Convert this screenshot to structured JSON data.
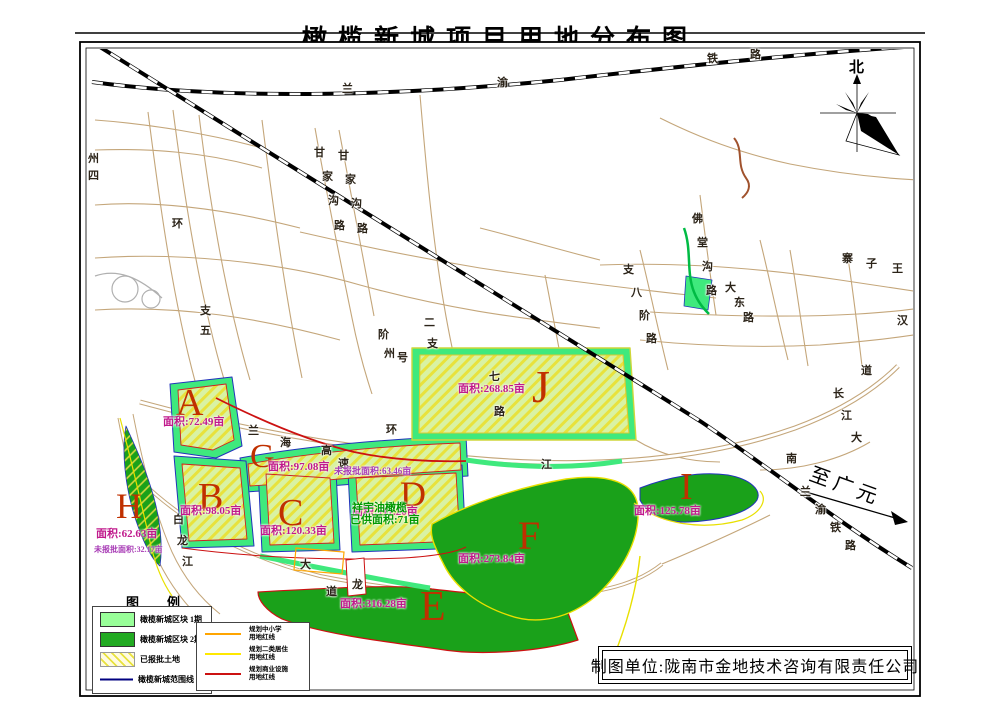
{
  "title": "橄榄新城项目用地分布图",
  "compass": {
    "north_label": "北"
  },
  "direction_note": {
    "text": "至广元"
  },
  "company_box": {
    "text": "制图单位:陇南市金地技术咨询有限责任公司"
  },
  "legend": {
    "title_char1": "图",
    "title_char2": "例",
    "swatches": [
      {
        "type": "sw-light",
        "label": "橄榄新城区块 1期"
      },
      {
        "type": "sw-dark",
        "label": "橄榄新城区块 2期"
      },
      {
        "type": "sw-hatch",
        "label": "已报批土地"
      },
      {
        "type": "sw-line",
        "label": "橄榄新城范围线"
      }
    ],
    "lines": [
      {
        "color": "#ffa500",
        "label1": "规划中小学",
        "label2": "用地红线"
      },
      {
        "color": "#ffe800",
        "label1": "规划二类居住",
        "label2": "用地红线"
      },
      {
        "color": "#cc1111",
        "label1": "规划商业设施",
        "label2": "用地红线"
      }
    ]
  },
  "zones": [
    {
      "letter": "A",
      "lx": 176,
      "ly": 384,
      "ls": 38,
      "area": "面积:72.49亩",
      "ax": 163,
      "ay": 417
    },
    {
      "letter": "G",
      "lx": 250,
      "ly": 440,
      "ls": 34,
      "area": "面积:97.08亩",
      "ax": 268,
      "ay": 462
    },
    {
      "letter": "B",
      "lx": 198,
      "ly": 478,
      "ls": 38,
      "area": "面积:98.05亩",
      "ax": 180,
      "ay": 506
    },
    {
      "letter": "C",
      "lx": 278,
      "ly": 494,
      "ls": 38,
      "area": "面积:120.33亩",
      "ax": 260,
      "ay": 526
    },
    {
      "letter": "D",
      "lx": 400,
      "ly": 476,
      "ls": 36,
      "area": "面积:111.20亩",
      "ax": 352,
      "ay": 507
    },
    {
      "letter": "J",
      "lx": 532,
      "ly": 364,
      "ls": 46,
      "area": "面积:268.85亩",
      "ax": 458,
      "ay": 384
    },
    {
      "letter": "E",
      "lx": 420,
      "ly": 586,
      "ls": 42,
      "area": "面积:316.28亩",
      "ax": 340,
      "ay": 599
    },
    {
      "letter": "F",
      "lx": 518,
      "ly": 516,
      "ls": 40,
      "area": "面积:273.84亩",
      "ax": 458,
      "ay": 554
    },
    {
      "letter": "H",
      "lx": 116,
      "ly": 488,
      "ls": 36,
      "area": "面积:62.63亩",
      "ax": 96,
      "ay": 529
    },
    {
      "letter": "I",
      "lx": 680,
      "ly": 468,
      "ls": 38,
      "area": "面积:125.78亩",
      "ax": 634,
      "ay": 506
    }
  ],
  "notes": [
    {
      "text": "未报批面积:63.46亩",
      "x": 334,
      "y": 467,
      "color": "#a73ab5",
      "size": 9
    },
    {
      "text": "祥宇油橄榄",
      "x": 352,
      "y": 502,
      "color": "#009900",
      "size": 11
    },
    {
      "text": "已供面积:71亩",
      "x": 350,
      "y": 514,
      "color": "#009900",
      "size": 11
    },
    {
      "text": "未报批面积:32.17亩",
      "x": 94,
      "y": 546,
      "color": "#a73ab5",
      "size": 8
    }
  ],
  "map_labels": [
    {
      "t": "兰",
      "x": 342,
      "y": 84
    },
    {
      "t": "渝",
      "x": 497,
      "y": 78
    },
    {
      "t": "铁",
      "x": 707,
      "y": 54
    },
    {
      "t": "路",
      "x": 750,
      "y": 50
    },
    {
      "t": "兰",
      "x": 800,
      "y": 487
    },
    {
      "t": "渝",
      "x": 815,
      "y": 505
    },
    {
      "t": "铁",
      "x": 830,
      "y": 523
    },
    {
      "t": "路",
      "x": 845,
      "y": 541
    },
    {
      "t": "兰",
      "x": 248,
      "y": 426
    },
    {
      "t": "海",
      "x": 280,
      "y": 438
    },
    {
      "t": "高",
      "x": 321,
      "y": 446
    },
    {
      "t": "速",
      "x": 338,
      "y": 459
    },
    {
      "t": "甘",
      "x": 314,
      "y": 148
    },
    {
      "t": "家",
      "x": 322,
      "y": 172
    },
    {
      "t": "沟",
      "x": 328,
      "y": 196
    },
    {
      "t": "路",
      "x": 334,
      "y": 221
    },
    {
      "t": "甘",
      "x": 338,
      "y": 151
    },
    {
      "t": "家",
      "x": 345,
      "y": 175
    },
    {
      "t": "沟",
      "x": 351,
      "y": 199
    },
    {
      "t": "路",
      "x": 357,
      "y": 224
    },
    {
      "t": "佛",
      "x": 692,
      "y": 214
    },
    {
      "t": "堂",
      "x": 697,
      "y": 238
    },
    {
      "t": "沟",
      "x": 702,
      "y": 262
    },
    {
      "t": "路",
      "x": 706,
      "y": 286
    },
    {
      "t": "大",
      "x": 725,
      "y": 283
    },
    {
      "t": "东",
      "x": 734,
      "y": 298
    },
    {
      "t": "路",
      "x": 743,
      "y": 313
    },
    {
      "t": "支",
      "x": 623,
      "y": 265
    },
    {
      "t": "八",
      "x": 631,
      "y": 288
    },
    {
      "t": "阶",
      "x": 639,
      "y": 311
    },
    {
      "t": "路",
      "x": 646,
      "y": 334
    },
    {
      "t": "七",
      "x": 489,
      "y": 372
    },
    {
      "t": "路",
      "x": 494,
      "y": 407
    },
    {
      "t": "道",
      "x": 861,
      "y": 366
    },
    {
      "t": "长",
      "x": 833,
      "y": 389
    },
    {
      "t": "江",
      "x": 841,
      "y": 411
    },
    {
      "t": "大",
      "x": 851,
      "y": 433
    },
    {
      "t": "南",
      "x": 786,
      "y": 454
    },
    {
      "t": "江",
      "x": 541,
      "y": 460
    },
    {
      "t": "白",
      "x": 173,
      "y": 515
    },
    {
      "t": "龙",
      "x": 177,
      "y": 536
    },
    {
      "t": "江",
      "x": 182,
      "y": 557
    },
    {
      "t": "龙",
      "x": 352,
      "y": 580
    },
    {
      "t": "大",
      "x": 300,
      "y": 560
    },
    {
      "t": "道",
      "x": 326,
      "y": 587
    },
    {
      "t": "支",
      "x": 200,
      "y": 306
    },
    {
      "t": "五",
      "x": 200,
      "y": 326
    },
    {
      "t": "州",
      "x": 88,
      "y": 154
    },
    {
      "t": "四",
      "x": 88,
      "y": 171
    },
    {
      "t": "二",
      "x": 424,
      "y": 318
    },
    {
      "t": "支",
      "x": 427,
      "y": 339
    },
    {
      "t": "号",
      "x": 397,
      "y": 353
    },
    {
      "t": "阶",
      "x": 378,
      "y": 330
    },
    {
      "t": "州",
      "x": 384,
      "y": 349
    },
    {
      "t": "环",
      "x": 386,
      "y": 425
    },
    {
      "t": "环",
      "x": 172,
      "y": 219
    },
    {
      "t": "寨",
      "x": 842,
      "y": 254
    },
    {
      "t": "子",
      "x": 866,
      "y": 259
    },
    {
      "t": "王",
      "x": 892,
      "y": 264
    },
    {
      "t": "汉",
      "x": 897,
      "y": 316
    }
  ],
  "colors": {
    "phase1_green": "#3fe97d",
    "phase2_green": "#1aa11a",
    "hatch_yellow": "#e8e23c",
    "boundary_blue": "#2233bb",
    "red_line": "#cc1111",
    "yellow_line": "#e8e000",
    "orange_line": "#ffa500",
    "area_label": "#c01a8c",
    "zone_letter": "#c03000"
  }
}
